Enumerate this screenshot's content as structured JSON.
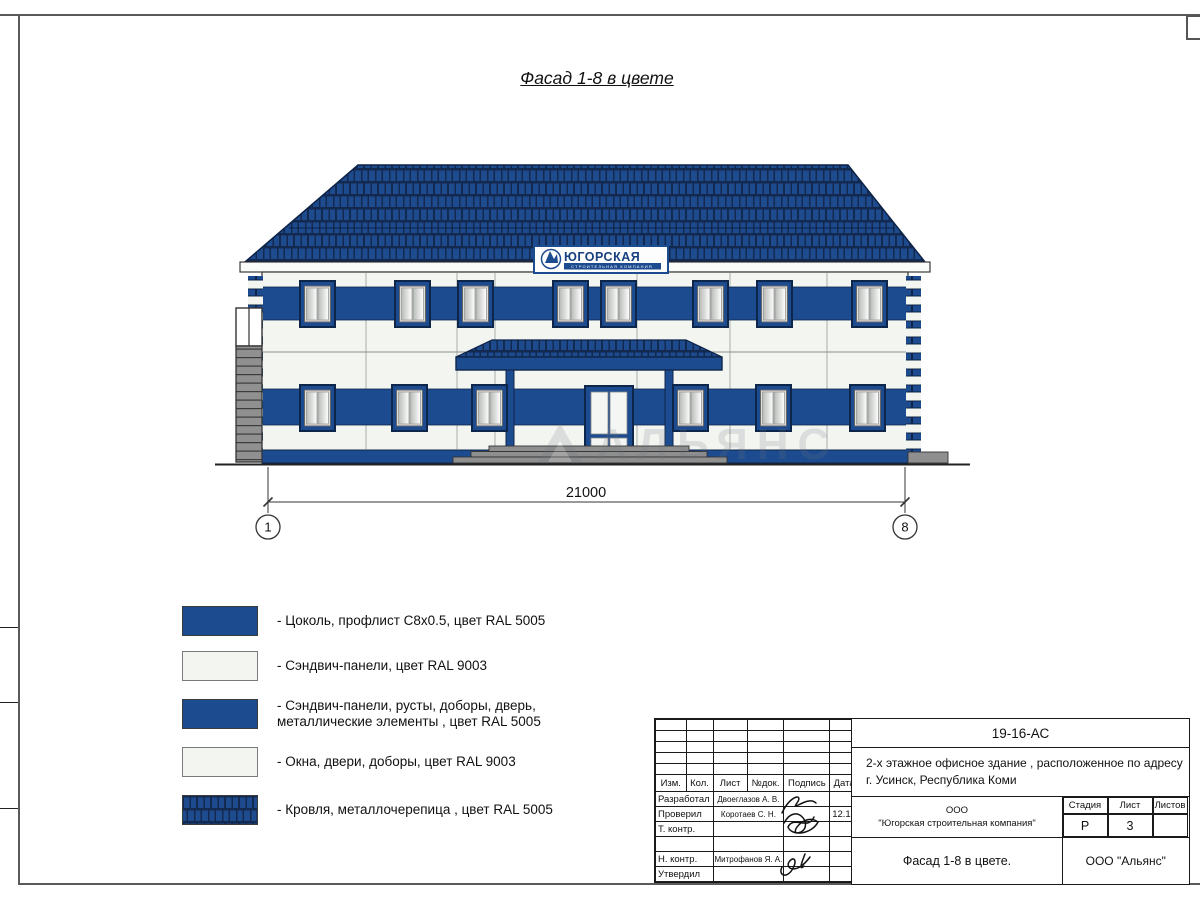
{
  "page": {
    "title": "Фасад 1-8 в цвете"
  },
  "colors": {
    "ral5005_blue": "#1d4b90",
    "ral9003_white": "#f3f5f1",
    "roof_blue": "#1e4a8e",
    "gray": "#8f8f8f"
  },
  "sign": {
    "name": "ЮГОРСКАЯ",
    "subtitle": "СТРОИТЕЛЬНАЯ КОМПАНИЯ"
  },
  "dimension": {
    "value": "21000",
    "axis_left": "1",
    "axis_right": "8"
  },
  "watermark": "АЛЬЯНС",
  "legend": {
    "items": [
      {
        "swatch": "blue",
        "label": "- Цоколь, профлист С8х0.5, цвет RAL 5005"
      },
      {
        "swatch": "white",
        "label": "- Сэндвич-панели, цвет RAL 9003"
      },
      {
        "swatch": "blue",
        "label": "- Сэндвич-панели, русты, доборы, дверь,",
        "label2": "металлические элементы , цвет RAL 5005"
      },
      {
        "swatch": "white",
        "label": "- Окна, двери, доборы, цвет RAL 9003"
      },
      {
        "swatch": "roof",
        "label": "- Кровля, металлочерепица , цвет RAL 5005"
      }
    ]
  },
  "titleblock": {
    "doc_number": "19-16-АС",
    "project_line1": "2-х этажное офисное здание , расположенное по адресу",
    "project_line2": "г. Усинск, Республика Коми",
    "header": {
      "izm": "Изм.",
      "kol": "Кол.",
      "list": "Лист",
      "ndok": "№док.",
      "podpis": "Подпись",
      "data": "Дата"
    },
    "rows": [
      {
        "role": "Разработал",
        "name": "Двоеглазов А. В.",
        "date": ""
      },
      {
        "role": "Проверил",
        "name": "Коротаев С. Н.",
        "date": "12.16"
      },
      {
        "role": "Т. контр.",
        "name": "",
        "date": ""
      },
      {
        "role": "",
        "name": "",
        "date": ""
      },
      {
        "role": "Н. контр.",
        "name": "Митрофанов Я. А.",
        "date": ""
      },
      {
        "role": "Утвердил",
        "name": "",
        "date": ""
      }
    ],
    "company_line1": "ООО",
    "company_line2": "\"Югорская строительная компания\"",
    "stage_label": "Стадия",
    "sheet_label": "Лист",
    "sheets_label": "Листов",
    "stage": "Р",
    "sheet": "3",
    "sheets": "",
    "drawing_title": "Фасад 1-8 в цвете.",
    "org": "ООО \"Альянс\""
  }
}
